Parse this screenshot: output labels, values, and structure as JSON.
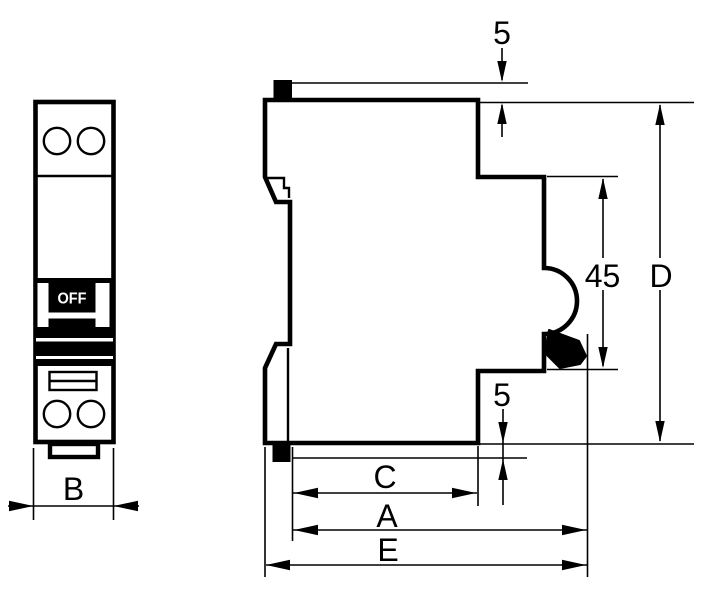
{
  "drawing": {
    "kind": "technical dimension drawing",
    "subject": "single-pole miniature circuit breaker",
    "colors": {
      "ink": "#000000",
      "paper": "#ffffff",
      "toggle_text": "#ffffff"
    },
    "front_view": {
      "name": "front view",
      "toggle_state": "OFF",
      "width_dim_label": "B"
    },
    "side_view": {
      "name": "side profile view",
      "dims": {
        "top_offset": "5",
        "front_face_height": "45",
        "overall_height": "D",
        "bottom_offset": "5",
        "base_depth": "C",
        "body_depth": "A",
        "overall_depth": "E"
      }
    }
  }
}
